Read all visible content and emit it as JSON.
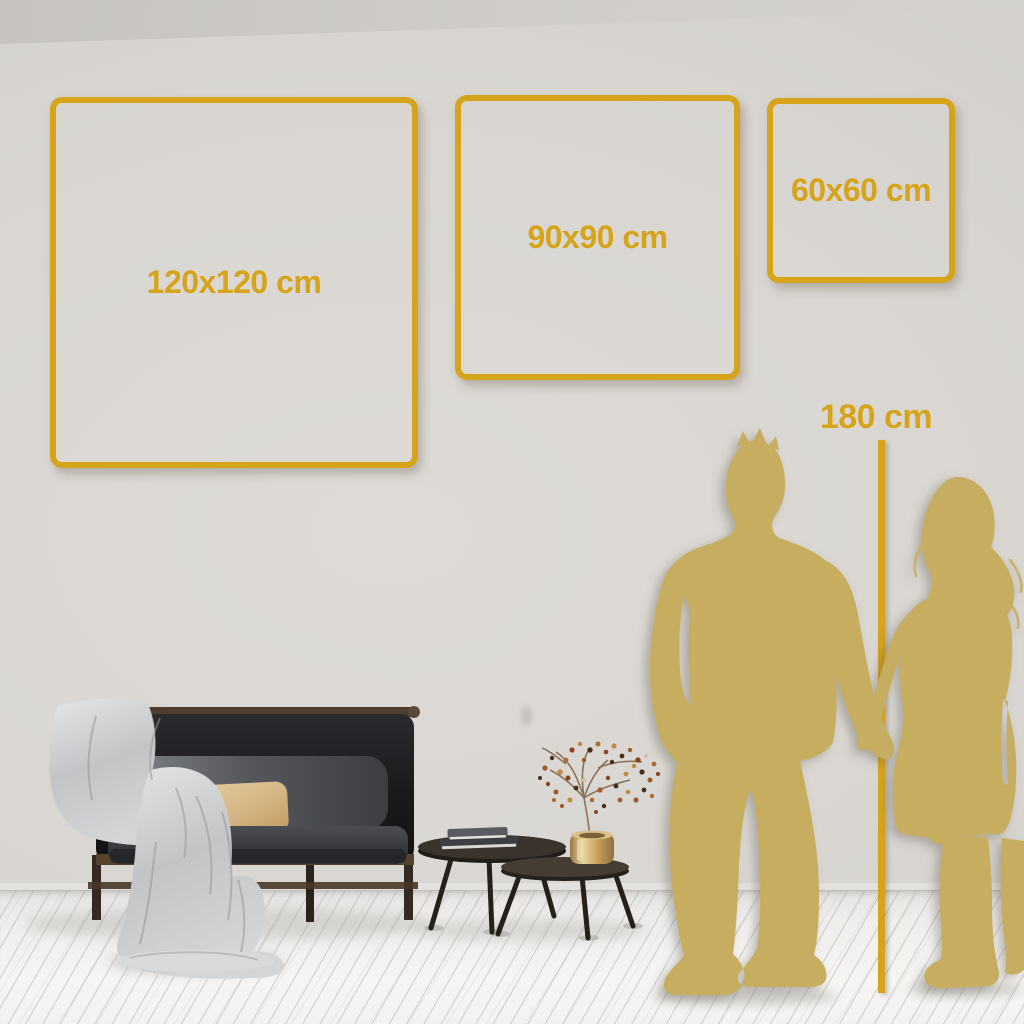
{
  "colors": {
    "accent_gold": "#d6a41a",
    "silhouette_gold": "#c6ad5e",
    "wall_gray": "#d9d6d2",
    "floor_white": "#f2f1ef"
  },
  "size_guide": {
    "frames": [
      {
        "label": "120x120 cm"
      },
      {
        "label": "90x90 cm"
      },
      {
        "label": "60x60 cm"
      }
    ],
    "height_ruler_label": "180 cm"
  }
}
